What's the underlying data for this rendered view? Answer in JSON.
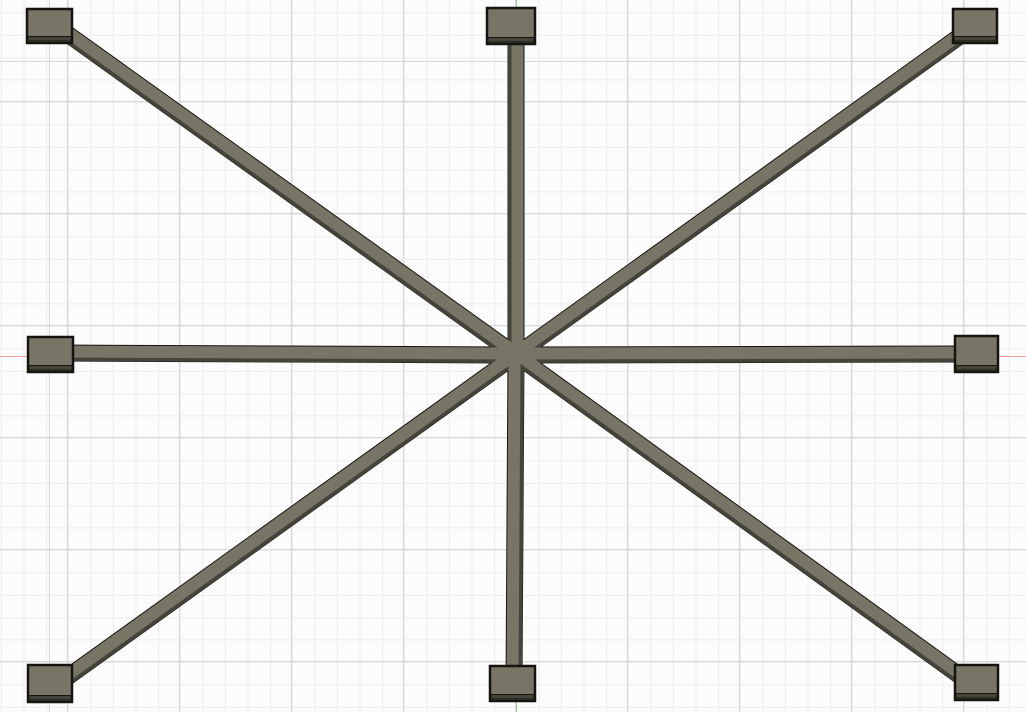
{
  "window": {
    "width_px": 1026,
    "height_px": 712
  },
  "viewport": {
    "background_color": "#fcfcfc",
    "grid": {
      "minor_spacing_px": 22.4,
      "major_spacing_px": 112,
      "minor_line_color": "#ededed",
      "major_line_color": "#d7d7d7"
    },
    "origin_axes": {
      "x_axis": {
        "color": "#f09c9c",
        "screen_y_px": 356
      },
      "y_axis": {
        "color": "#8ed48e",
        "screen_x_px": 516
      }
    }
  },
  "model": {
    "face_color": "#787567",
    "side_color": "#45443b",
    "edge_color": "#15150f",
    "center_px": [
      516,
      355
    ],
    "spoke_outline_width_px": 17,
    "spoke_side_width_px": 13,
    "spoke_face_width_px": 12,
    "spokes": [
      {
        "id": "spoke-n",
        "end": [
          516,
          27
        ]
      },
      {
        "id": "spoke-ne",
        "end": [
          967,
          31
        ]
      },
      {
        "id": "spoke-e",
        "end": [
          973,
          354
        ]
      },
      {
        "id": "spoke-se",
        "end": [
          967,
          681
        ]
      },
      {
        "id": "spoke-s",
        "end": [
          514,
          684
        ]
      },
      {
        "id": "spoke-sw",
        "end": [
          62,
          681
        ]
      },
      {
        "id": "spoke-w",
        "end": [
          53,
          353
        ]
      },
      {
        "id": "spoke-nw",
        "end": [
          62,
          30
        ]
      }
    ],
    "pads": [
      {
        "id": "pad-nw",
        "x": 27,
        "y": 9,
        "w": 45,
        "h": 34
      },
      {
        "id": "pad-n",
        "x": 487,
        "y": 8,
        "w": 48,
        "h": 36
      },
      {
        "id": "pad-ne",
        "x": 953,
        "y": 9,
        "w": 44,
        "h": 34
      },
      {
        "id": "pad-w",
        "x": 28,
        "y": 337,
        "w": 45,
        "h": 35
      },
      {
        "id": "pad-e",
        "x": 955,
        "y": 336,
        "w": 43,
        "h": 36
      },
      {
        "id": "pad-sw",
        "x": 28,
        "y": 665,
        "w": 44,
        "h": 37
      },
      {
        "id": "pad-s",
        "x": 490,
        "y": 666,
        "w": 45,
        "h": 35
      },
      {
        "id": "pad-se",
        "x": 955,
        "y": 665,
        "w": 43,
        "h": 35
      }
    ]
  }
}
